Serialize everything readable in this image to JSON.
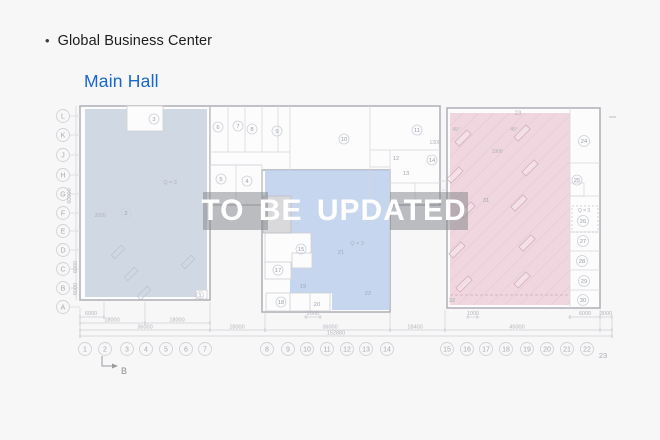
{
  "header": {
    "bullet": "•",
    "title": "Global Business Center",
    "subtitle": "Main Hall"
  },
  "watermark": {
    "text": "TO BE UPDATED"
  },
  "plan": {
    "row_labels": [
      "L",
      "K",
      "J",
      "H",
      "G",
      "F",
      "E",
      "D",
      "C",
      "B",
      "A"
    ],
    "col_labels": [
      "1",
      "2",
      "3",
      "4",
      "5",
      "6",
      "7",
      "8",
      "9",
      "10",
      "11",
      "12",
      "13",
      "14",
      "15",
      "16",
      "17",
      "18",
      "19",
      "20",
      "21",
      "22"
    ],
    "col_23": "23",
    "section_marker": "B",
    "rooms_circled": [
      "1",
      "2",
      "3",
      "4",
      "5",
      "6",
      "7",
      "8",
      "9",
      "10",
      "11",
      "14",
      "15",
      "17",
      "18",
      "24",
      "25",
      "26",
      "27",
      "28",
      "29",
      "30"
    ],
    "rooms_plain": [
      "12",
      "13",
      "19",
      "20",
      "21",
      "22",
      "31",
      "32"
    ],
    "annotations": [
      "Q = 3",
      "Q = 3",
      "Q = 3",
      "45°",
      "45°",
      "1900",
      "1300",
      "2000",
      "23"
    ],
    "dims_bottom": [
      "6000",
      "2000",
      "1000",
      "6000",
      "3000",
      "18000",
      "18000",
      "36000",
      "18000",
      "36000",
      "18400",
      "45000",
      "152880"
    ],
    "dims_left": [
      "60000",
      "6000",
      "6000"
    ]
  },
  "colors": {
    "accent_blue": "#1668cd",
    "zone_gray_blue": "#c9d4df",
    "zone_blue": "#bccfec",
    "zone_pink": "#eed2db",
    "watermark_box": "rgba(128,130,136,0.5)"
  }
}
